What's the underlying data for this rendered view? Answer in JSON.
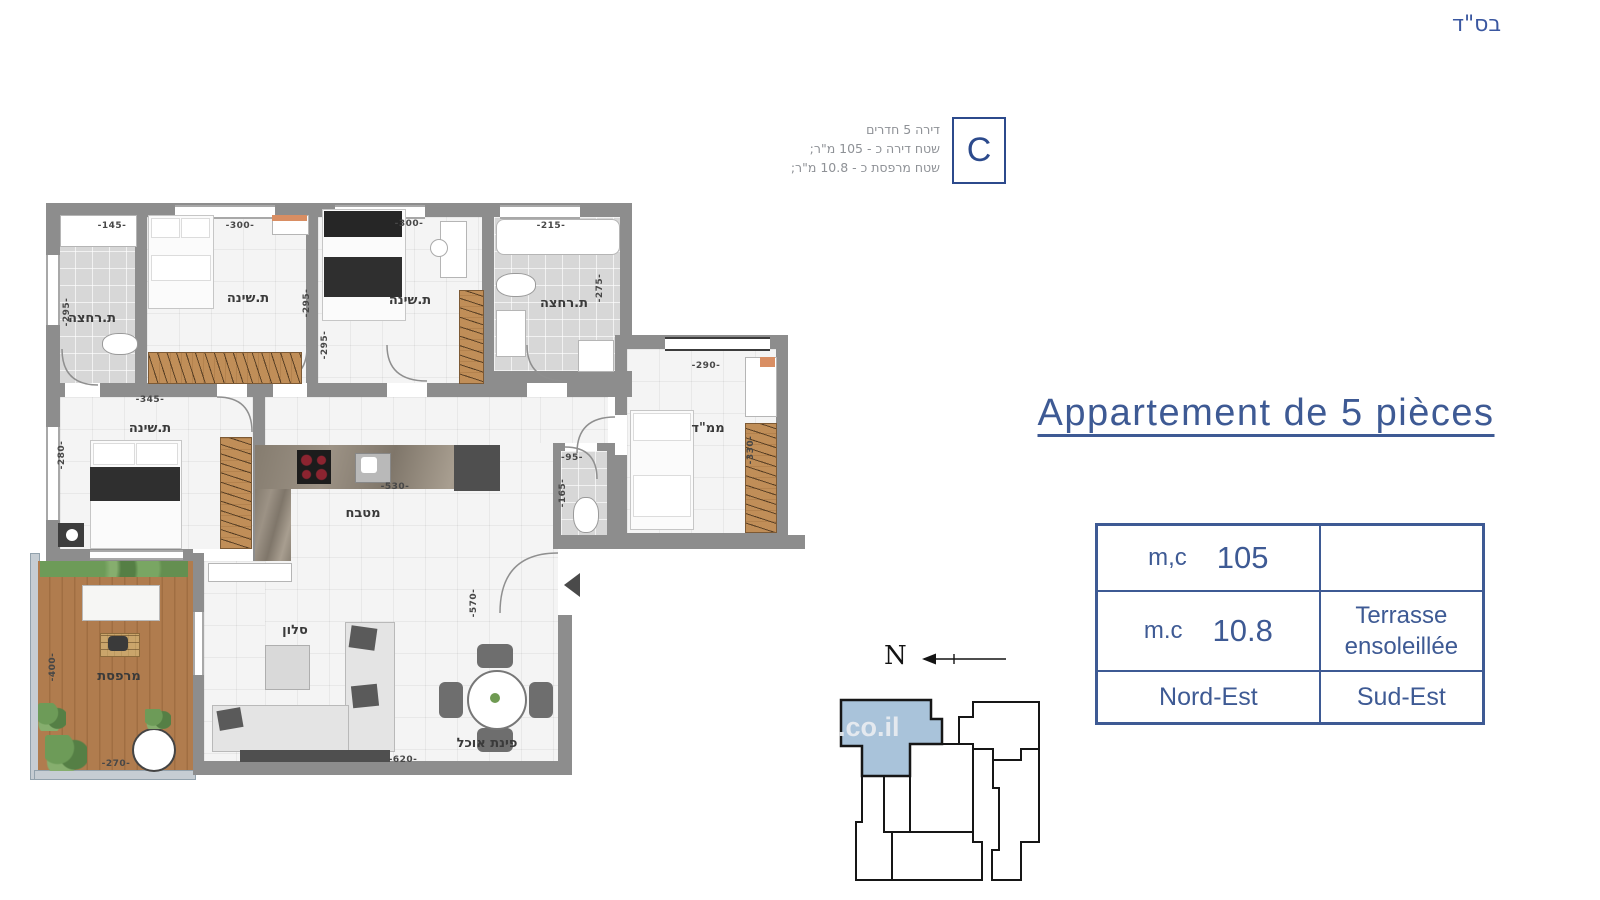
{
  "page": {
    "bsd": "בס\"ד"
  },
  "unit_info": {
    "letter": "C",
    "lines": [
      "דירה 5 חדרים",
      "שטח דירה כ - 105 מ\"ר;",
      "שטח מרפסת כ - 10.8 מ\"ר;"
    ]
  },
  "title": {
    "text": "Appartement de 5 pièces"
  },
  "spec_table": {
    "area_label": "m,c",
    "area_value": "105",
    "terrace_label": "m.c",
    "terrace_value": "10.8",
    "terrace_name_line1": "Terrasse",
    "terrace_name_line2": "ensoleillée",
    "orientation_main": "Nord-Est",
    "orientation_terrace": "Sud-Est"
  },
  "compass": {
    "letter": "N"
  },
  "watermark": {
    "text": ".co.il"
  },
  "colors": {
    "accent": "#3e5a94",
    "wall": "#8d8d8d",
    "keyplan_highlight": "#a9c3da"
  },
  "plan": {
    "rooms": {
      "bath_top_left": {
        "label": "ת.רחצה",
        "dim_w": "-145-",
        "dim_h": "-295-"
      },
      "bedroom_top_1": {
        "label": "ת.שינה",
        "dim_w": "-300-",
        "dim_h": "-295-"
      },
      "bedroom_top_2": {
        "label": "ת.שינה",
        "dim_w": "-300-",
        "dim_h": "-295-"
      },
      "bath_top_right": {
        "label": "ת.רחצה",
        "dim_w": "-215-",
        "dim_h": "-275-"
      },
      "mamad": {
        "label": "ממ\"ד",
        "dim_w": "-290-",
        "dim_h": "-330-"
      },
      "master_bedroom": {
        "label": "ת.שינה",
        "dim_w": "-345-",
        "dim_h": "-280-"
      },
      "kitchen": {
        "label": "מטבח",
        "dim_w": "-530-"
      },
      "wc": {
        "dim_w": "-95-",
        "dim_h": "-165-"
      },
      "living": {
        "label": "סלון",
        "dim_w": "-620-",
        "dim_h": "-570-"
      },
      "dining": {
        "label": "פינת אוכל"
      },
      "balcony": {
        "label": "מרפסת",
        "dim_w": "-270-",
        "dim_h": "-400-"
      }
    }
  }
}
